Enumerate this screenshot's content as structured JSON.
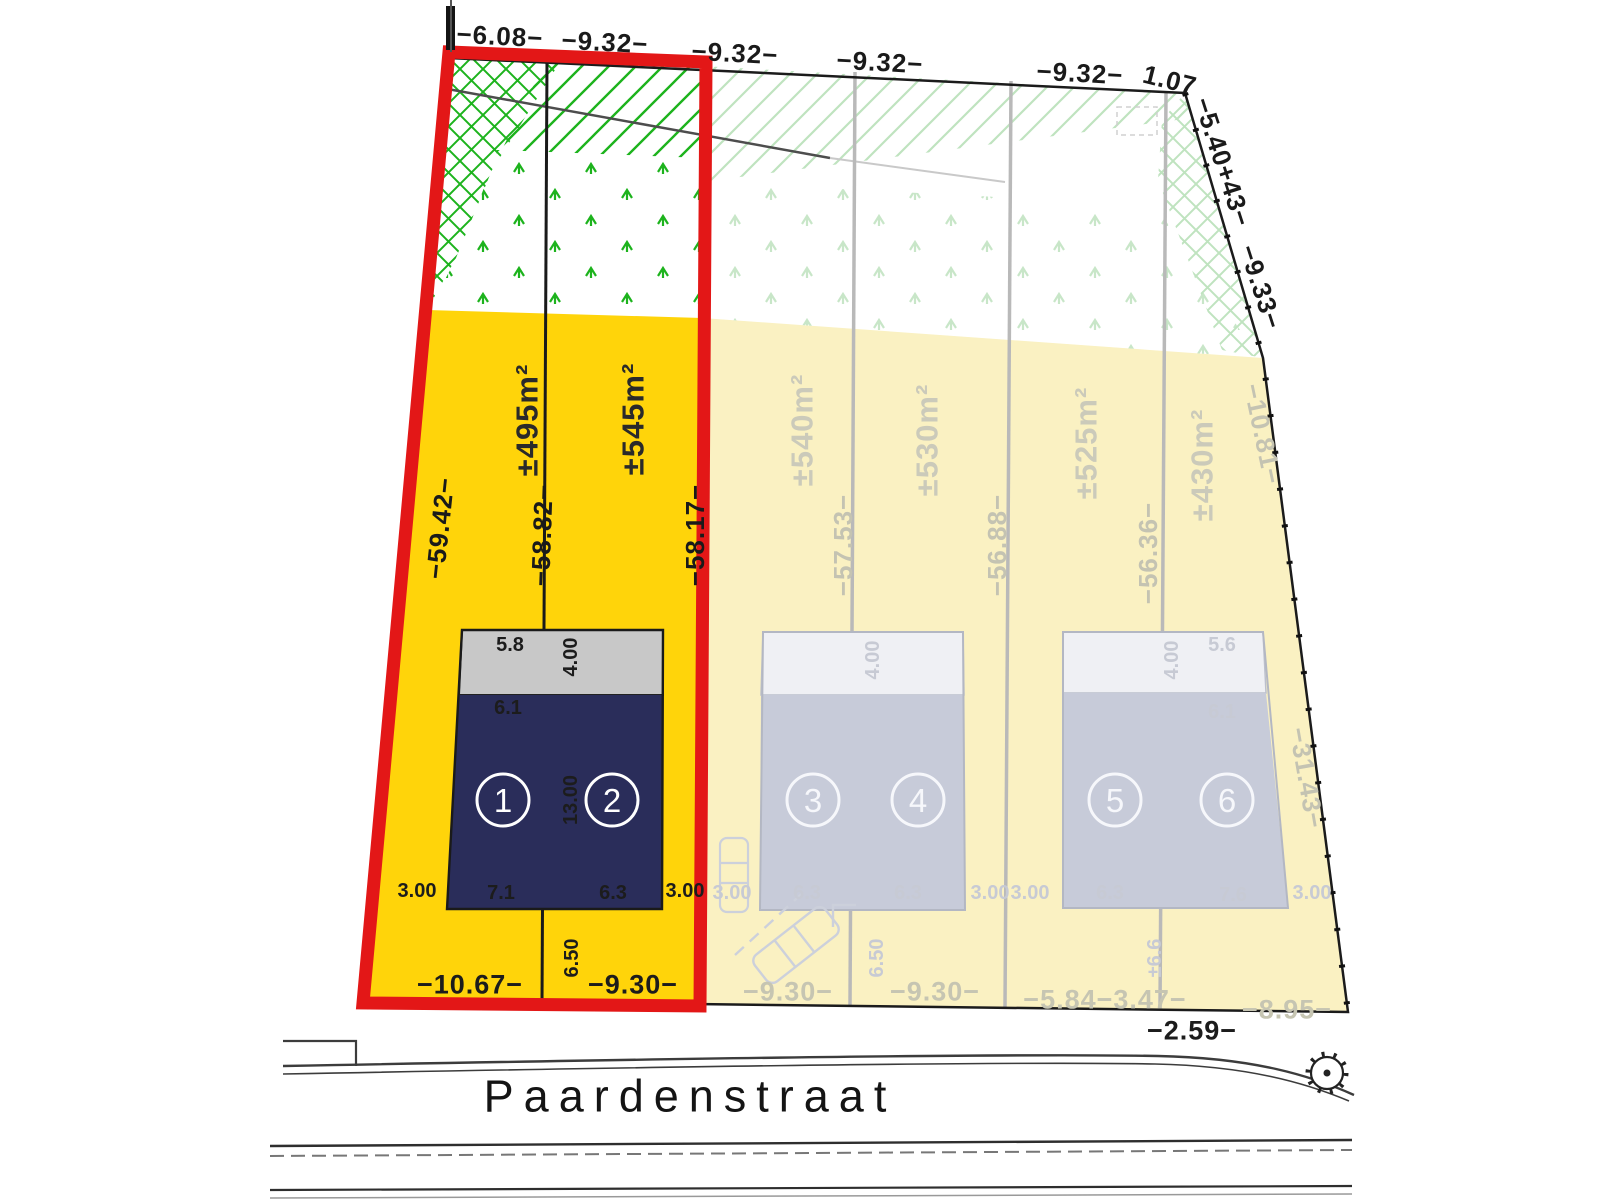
{
  "drawing": {
    "street_name": "Paardenstraat",
    "top_dimensions": [
      "−6.08−",
      "−9.32−",
      "−9.32−",
      "−9.32−",
      "−9.32−",
      "1.07"
    ],
    "right_edge_dimensions": [
      "−5.40+43−",
      "−9.33−",
      "−10.81−",
      "−31.43−"
    ],
    "bottom_edge_dimension": "−2.59−",
    "plots": [
      {
        "number": "1",
        "area": "±495m²",
        "left_dim": "−59.42−",
        "right_dim": "−58.82−",
        "bottom_dim": "−10.67−",
        "highlighted": true
      },
      {
        "number": "2",
        "area": "±545m²",
        "right_dim": "−58.17−",
        "bottom_dim": "−9.30−",
        "highlighted": true
      },
      {
        "number": "3",
        "area": "±540m²",
        "right_dim": "−57.53−",
        "bottom_dim": "−9.30−",
        "highlighted": false
      },
      {
        "number": "4",
        "area": "±530m²",
        "right_dim": "−56.88−",
        "bottom_dim": "−9.30−",
        "highlighted": false
      },
      {
        "number": "5",
        "area": "±525m²",
        "right_dim": "−56.36−",
        "bottom_dim": "−5.84−3.47−",
        "highlighted": false
      },
      {
        "number": "6",
        "area": "±430m²",
        "bottom_dim": "−8.95−",
        "highlighted": false
      }
    ],
    "building_1_2": {
      "top_width": "5.8",
      "garage_depth": "4.00",
      "inner_width": "6.1",
      "main_depth": "13.00",
      "bottom_width_left": "7.1",
      "bottom_width_right": "6.3",
      "setback_left": "3.00",
      "setback_right": "3.00",
      "front_setback": "6.50"
    },
    "building_3_4": {
      "garage_depth": "4.00",
      "bottom_width_left": "6.3",
      "bottom_width_right": "6.3",
      "setback_left": "3.00",
      "setback_right": "3.00",
      "front_setback": "6.50"
    },
    "building_5_6": {
      "garage_depth": "4.00",
      "top_width": "5.6",
      "inner_width": "6.1",
      "bottom_width_left": "6.3",
      "bottom_width_right": "7.6",
      "setback_left": "3.00",
      "setback_right": "3.00",
      "front_setback": "±6.6"
    },
    "colors": {
      "highlight_fill": "#FFD40A",
      "muted_fill": "#FAF1C2",
      "building_dark": "#2A2D5A",
      "building_muted": "#C7CBD9",
      "outline_red": "#E31717",
      "hatch_green": "#1DB31D",
      "hatch_green_muted": "#BFE3BF"
    }
  }
}
